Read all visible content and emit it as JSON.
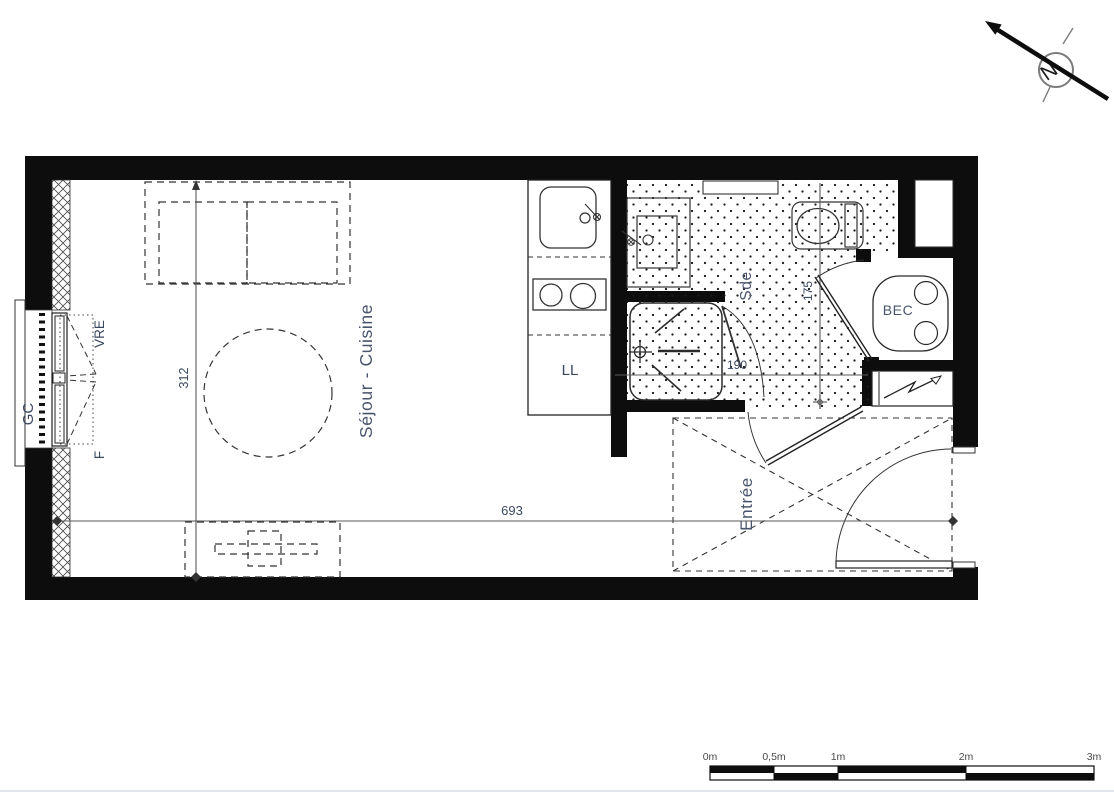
{
  "plan": {
    "rooms": {
      "living": {
        "label": "Séjour - Cuisine"
      },
      "bathroom": {
        "label": "Sde"
      },
      "entrance": {
        "label": "Entrée"
      }
    },
    "fixtures": {
      "washing_machine": "LL",
      "water_heater": "BEC"
    },
    "window": {
      "guard_rail": "GC",
      "shutter": "VRE",
      "window": "F"
    },
    "dimensions": {
      "living_width": "312",
      "total_length": "693",
      "bathroom_length": "190",
      "bathroom_width": "175"
    },
    "compass": {
      "north": "N"
    }
  },
  "scale_bar": {
    "labels": [
      "0m",
      "0,5m",
      "1m",
      "2m",
      "3m"
    ]
  },
  "colors": {
    "wall": "#0d0d0d",
    "linework": "#2b2b2b",
    "room_label": "#4a556d",
    "dimension_label": "#3b4860",
    "scale_label": "#4a4a4a"
  }
}
